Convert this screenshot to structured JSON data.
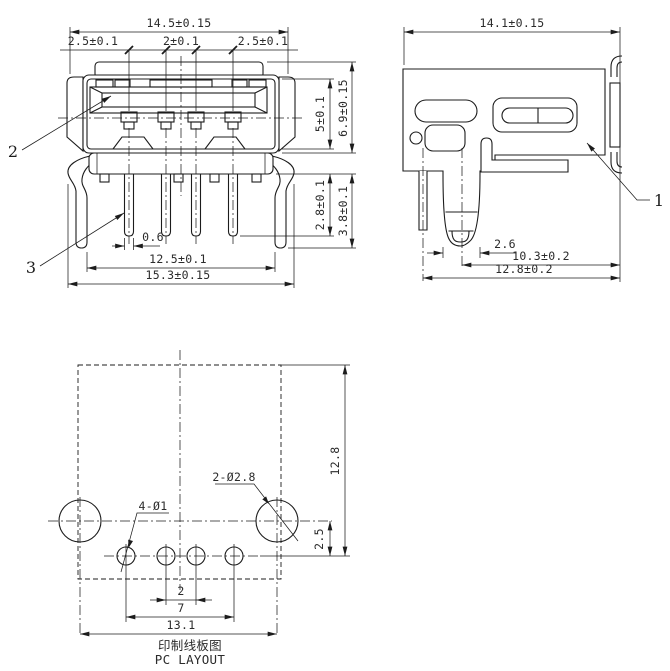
{
  "front_view": {
    "dim_overall_width": "14.5±0.15",
    "dim_pitch_left": "2.5±0.1",
    "dim_pitch_center": "2±0.1",
    "dim_pitch_right": "2.5±0.1",
    "dim_shell_height": "5±0.1",
    "dim_overall_height": "6.9±0.15",
    "dim_pin_length_inner": "2.8±0.1",
    "dim_pin_length_outer": "3.8±0.1",
    "dim_pin_width": "0.6",
    "dim_leg_span": "12.5±0.1",
    "dim_bottom_width": "15.3±0.15",
    "balloon_shell": "2",
    "balloon_pin": "3"
  },
  "side_view": {
    "dim_overall_depth": "14.1±0.15",
    "dim_leg_width": "2.6",
    "dim_leg_to_face": "10.3±0.2",
    "dim_pin_to_face": "12.8±0.2",
    "balloon_body": "1"
  },
  "pc_layout": {
    "dim_board_depth": "12.8",
    "dim_hole_row_offset": "2.5",
    "callout_big_holes": "2-Ø2.8",
    "callout_small_holes": "4-Ø1",
    "dim_pin_pitch": "2",
    "dim_pin_span": "7",
    "dim_big_hole_span": "13.1",
    "caption_cn": "印制线板图",
    "caption_en": "PC LAYOUT"
  },
  "colors": {
    "line": "#1c1c1c",
    "background": "#ffffff"
  }
}
